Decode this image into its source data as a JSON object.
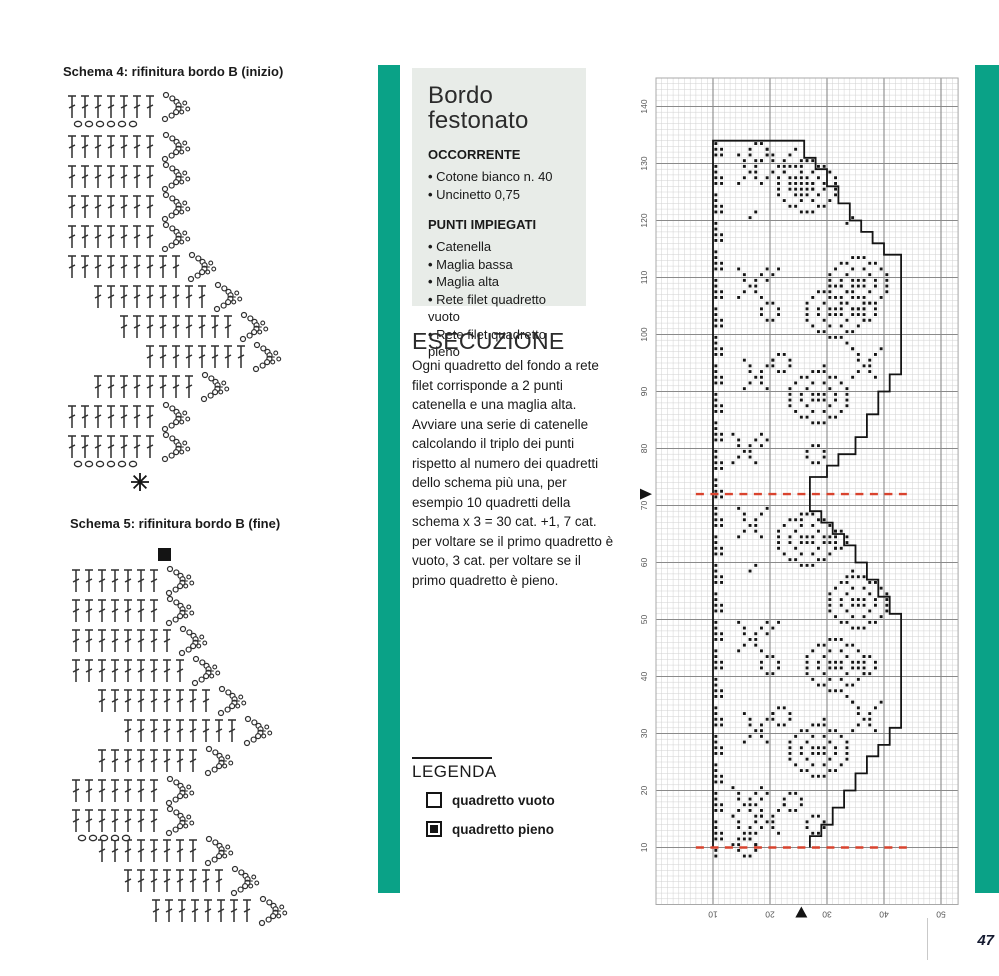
{
  "page": {
    "number": "47"
  },
  "colors": {
    "teal_bar": "#0aa287",
    "info_box_bg": "#e8ece8",
    "red_dash": "#d9432e",
    "ink": "#1a1a1a",
    "grid_light": "#d2d2d2",
    "grid_dark": "#8a8a8a",
    "outline": "#141414"
  },
  "left": {
    "schema4_title": "Schema 4: rifinitura bordo B (inizio)",
    "schema5_title": "Schema 5: rifinitura bordo B (fine)",
    "schema4": {
      "marker": "star",
      "marker_pos": [
        84,
        394
      ],
      "rows": [
        {
          "x": 16,
          "y": 6,
          "n": 7
        },
        {
          "x": 16,
          "y": 46,
          "n": 7
        },
        {
          "x": 16,
          "y": 76,
          "n": 7
        },
        {
          "x": 16,
          "y": 106,
          "n": 7
        },
        {
          "x": 16,
          "y": 136,
          "n": 7
        },
        {
          "x": 16,
          "y": 166,
          "n": 9
        },
        {
          "x": 42,
          "y": 196,
          "n": 9
        },
        {
          "x": 68,
          "y": 226,
          "n": 9
        },
        {
          "x": 94,
          "y": 256,
          "n": 8
        },
        {
          "x": 42,
          "y": 286,
          "n": 8
        },
        {
          "x": 16,
          "y": 316,
          "n": 7
        },
        {
          "x": 16,
          "y": 346,
          "n": 7
        }
      ],
      "chains": [
        {
          "x": 22,
          "y": 36,
          "n": 6,
          "dx": 11
        },
        {
          "x": 22,
          "y": 376,
          "n": 6,
          "dx": 11
        }
      ]
    },
    "schema5": {
      "marker": "square",
      "marker_pos": [
        98,
        2
      ],
      "rows": [
        {
          "x": 16,
          "y": 22,
          "n": 7
        },
        {
          "x": 16,
          "y": 52,
          "n": 7
        },
        {
          "x": 16,
          "y": 82,
          "n": 8
        },
        {
          "x": 16,
          "y": 112,
          "n": 9
        },
        {
          "x": 42,
          "y": 142,
          "n": 9
        },
        {
          "x": 68,
          "y": 172,
          "n": 9
        },
        {
          "x": 42,
          "y": 202,
          "n": 8
        },
        {
          "x": 16,
          "y": 232,
          "n": 7
        },
        {
          "x": 16,
          "y": 262,
          "n": 7
        },
        {
          "x": 42,
          "y": 292,
          "n": 8
        },
        {
          "x": 68,
          "y": 322,
          "n": 8
        },
        {
          "x": 96,
          "y": 352,
          "n": 8
        }
      ],
      "chains": [
        {
          "x": 22,
          "y": 292,
          "n": 5,
          "dx": 11
        }
      ]
    }
  },
  "info": {
    "title_line1": "Bordo",
    "title_line2": "festonato",
    "sections": [
      {
        "heading": "OCCORRENTE",
        "items": [
          "Cotone bianco n. 40",
          "Uncinetto 0,75"
        ]
      },
      {
        "heading": "PUNTI IMPIEGATI",
        "items": [
          "Catenella",
          "Maglia bassa",
          "Maglia alta",
          "Rete filet quadretto vuoto",
          "Rete filet quadretto pieno"
        ]
      }
    ],
    "esecuzione_heading": "ESECUZIONE",
    "esecuzione_text": "Ogni quadretto del fondo a rete filet corrisponde a 2 punti catenella e una maglia alta. Avviare una serie di catenelle calcolando il triplo dei punti rispetto al numero dei quadretti dello schema più una, per esempio 10 quadretti della schema x 3 = 30 cat. +1, 7 cat. per voltare se il primo quadretto è vuoto, 3 cat. per voltare se il primo quadretto è pieno.",
    "legend": {
      "heading": "LEGENDA",
      "items": [
        {
          "symbol": "empty-square",
          "label": "quadretto vuoto"
        },
        {
          "symbol": "filled-square",
          "label": "quadretto pieno"
        }
      ]
    }
  },
  "chart_data": {
    "type": "filet_crochet_grid",
    "title": "",
    "cols": 53,
    "rows": 145,
    "row_labels": [
      10,
      20,
      30,
      40,
      50,
      60,
      70,
      80,
      90,
      100,
      110,
      120,
      130,
      140
    ],
    "col_labels": [
      10,
      20,
      30,
      40,
      50
    ],
    "row_label_rotation_deg": -90,
    "col_label_rotation_deg": 180,
    "repeat_marker_rows": [
      10,
      72
    ],
    "red_dash_col_span": [
      7,
      44
    ],
    "side_triangle_row": 72,
    "bottom_triangle_col": 25.5,
    "outline": [
      [
        10,
        10
      ],
      [
        10,
        134
      ],
      [
        26,
        134
      ],
      [
        26,
        131
      ],
      [
        28,
        131
      ],
      [
        28,
        129
      ],
      [
        30,
        129
      ],
      [
        30,
        126
      ],
      [
        32,
        126
      ],
      [
        32,
        123
      ],
      [
        34,
        123
      ],
      [
        34,
        120
      ],
      [
        36,
        120
      ],
      [
        36,
        118
      ],
      [
        38,
        118
      ],
      [
        38,
        116
      ],
      [
        40,
        116
      ],
      [
        40,
        114
      ],
      [
        43,
        114
      ],
      [
        43,
        93
      ],
      [
        41,
        93
      ],
      [
        41,
        90
      ],
      [
        39,
        90
      ],
      [
        39,
        86
      ],
      [
        37,
        86
      ],
      [
        37,
        82
      ],
      [
        35,
        82
      ],
      [
        35,
        79
      ],
      [
        32,
        79
      ],
      [
        32,
        77
      ],
      [
        30,
        77
      ],
      [
        30,
        75
      ],
      [
        27,
        75
      ],
      [
        27,
        69
      ],
      [
        29,
        69
      ],
      [
        29,
        67
      ],
      [
        31,
        67
      ],
      [
        31,
        65
      ],
      [
        33,
        65
      ],
      [
        33,
        63
      ],
      [
        35,
        63
      ],
      [
        35,
        60
      ],
      [
        37,
        60
      ],
      [
        37,
        57
      ],
      [
        39,
        57
      ],
      [
        39,
        54
      ],
      [
        41,
        54
      ],
      [
        41,
        51
      ],
      [
        43,
        51
      ],
      [
        43,
        31
      ],
      [
        41,
        31
      ],
      [
        41,
        28
      ],
      [
        39,
        28
      ],
      [
        39,
        26
      ],
      [
        37,
        26
      ],
      [
        37,
        23
      ],
      [
        35,
        23
      ],
      [
        35,
        20
      ],
      [
        33,
        20
      ],
      [
        33,
        17
      ],
      [
        31,
        17
      ],
      [
        31,
        14
      ],
      [
        29,
        14
      ],
      [
        29,
        12
      ],
      [
        27,
        12
      ],
      [
        27,
        10
      ]
    ],
    "border_chain": {
      "cols": [
        10,
        11
      ],
      "from": 8,
      "to": 133
    },
    "motif_bitmaps": {
      "rose": [
        "....###....",
        "..##...##..",
        ".#..#.#..#.",
        "#..#...#..#",
        "#.#.###.#.#",
        "#.#.###.#.#",
        "#..#...#..#",
        ".#..#.#..#.",
        "..##...##..",
        "....###...."
      ],
      "leaf": [
        "#....#",
        ".#..#.",
        ".#.#..",
        "..##..",
        ".#.#..",
        "#...#."
      ],
      "bud": [
        ".##.",
        "#..#",
        "#..#",
        ".##."
      ]
    },
    "motifs": [
      {
        "m": "rose",
        "c": 26,
        "r": 37
      },
      {
        "m": "rose",
        "c": 21,
        "r": 59
      },
      {
        "m": "rose",
        "c": 23,
        "r": 22
      },
      {
        "m": "rose",
        "c": 30,
        "r": 48
      },
      {
        "m": "leaf",
        "c": 14,
        "r": 44
      },
      {
        "m": "leaf",
        "c": 15,
        "r": 28
      },
      {
        "m": "leaf",
        "c": 13,
        "r": 15
      },
      {
        "m": "leaf",
        "c": 14,
        "r": 64
      },
      {
        "m": "leaf",
        "c": 34,
        "r": 30
      },
      {
        "m": "leaf",
        "c": 13,
        "r": 10
      },
      {
        "m": "bud",
        "c": 30,
        "r": 62
      },
      {
        "m": "bud",
        "c": 35,
        "r": 40
      },
      {
        "m": "bud",
        "c": 18,
        "r": 40
      },
      {
        "m": "bud",
        "c": 20,
        "r": 31
      },
      {
        "m": "bud",
        "c": 26,
        "r": 12
      },
      {
        "m": "bud",
        "c": 22,
        "r": 16
      },
      {
        "m": "leaf",
        "c": 17,
        "r": 12
      },
      {
        "m": "rose",
        "c": 26,
        "r": 99
      },
      {
        "m": "rose",
        "c": 21,
        "r": 121
      },
      {
        "m": "rose",
        "c": 23,
        "r": 84
      },
      {
        "m": "rose",
        "c": 30,
        "r": 104
      },
      {
        "m": "leaf",
        "c": 14,
        "r": 106
      },
      {
        "m": "leaf",
        "c": 15,
        "r": 90
      },
      {
        "m": "leaf",
        "c": 13,
        "r": 77
      },
      {
        "m": "leaf",
        "c": 14,
        "r": 126
      },
      {
        "m": "leaf",
        "c": 34,
        "r": 92
      },
      {
        "m": "leaf",
        "c": 19,
        "r": 127
      },
      {
        "m": "bud",
        "c": 24,
        "r": 124
      },
      {
        "m": "bud",
        "c": 35,
        "r": 102
      },
      {
        "m": "bud",
        "c": 18,
        "r": 102
      },
      {
        "m": "bud",
        "c": 20,
        "r": 93
      },
      {
        "m": "bud",
        "c": 26,
        "r": 77
      },
      {
        "m": "bud",
        "c": 16,
        "r": 130
      },
      {
        "m": "bud",
        "c": 14,
        "r": 8
      }
    ],
    "extra_dots": [
      [
        19,
        47
      ],
      [
        20,
        48
      ],
      [
        21,
        49
      ],
      [
        33,
        36
      ],
      [
        34,
        35
      ],
      [
        18,
        18
      ],
      [
        19,
        19
      ],
      [
        25,
        67
      ],
      [
        26,
        68
      ],
      [
        33,
        57
      ],
      [
        34,
        58
      ],
      [
        19,
        109
      ],
      [
        20,
        110
      ],
      [
        21,
        111
      ],
      [
        33,
        98
      ],
      [
        34,
        97
      ],
      [
        25,
        129
      ],
      [
        26,
        130
      ],
      [
        18,
        80
      ],
      [
        19,
        81
      ],
      [
        33,
        119
      ],
      [
        34,
        120
      ],
      [
        16,
        120
      ],
      [
        17,
        121
      ],
      [
        16,
        58
      ],
      [
        17,
        59
      ],
      [
        28,
        31
      ],
      [
        29,
        32
      ],
      [
        28,
        93
      ],
      [
        29,
        94
      ]
    ]
  }
}
